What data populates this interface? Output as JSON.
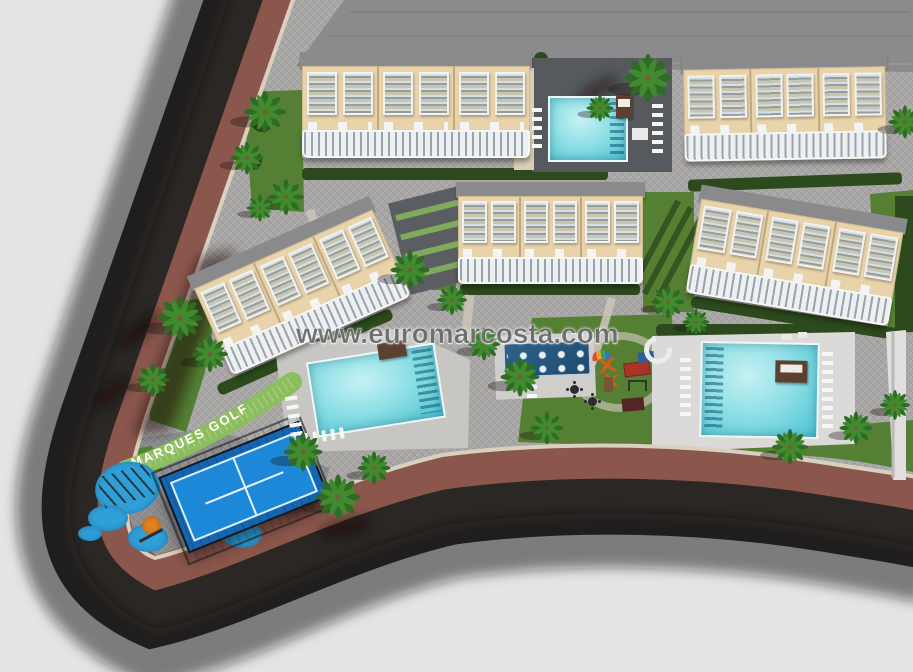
{
  "watermark": {
    "text": "www.euromarcosta.com"
  },
  "signage": {
    "path_label": "MARQUES GOLF"
  },
  "palette": {
    "background": "#e4e4e6",
    "road_asphalt": "#2b2725",
    "road_sidewalk": "#8b574d",
    "pavement": "#a7a6a4",
    "curb": "#d9d0bf",
    "lawn_green": "#557f33",
    "hedge_green": "#2c4a1d",
    "path_band_green": "#8cbe5d",
    "pool_water": "#7fdbe2",
    "splash_pool_blue": "#2a5c84",
    "padel_court_blue": "#1e88d8",
    "terrace_beige": "#e8d3ab",
    "roof_gray": "#8c8c8e",
    "railing_white": "#eef1f3",
    "wood_brown": "#5c4130",
    "play_orange": "#e07b1f",
    "play_blue": "#2f9fd8"
  }
}
